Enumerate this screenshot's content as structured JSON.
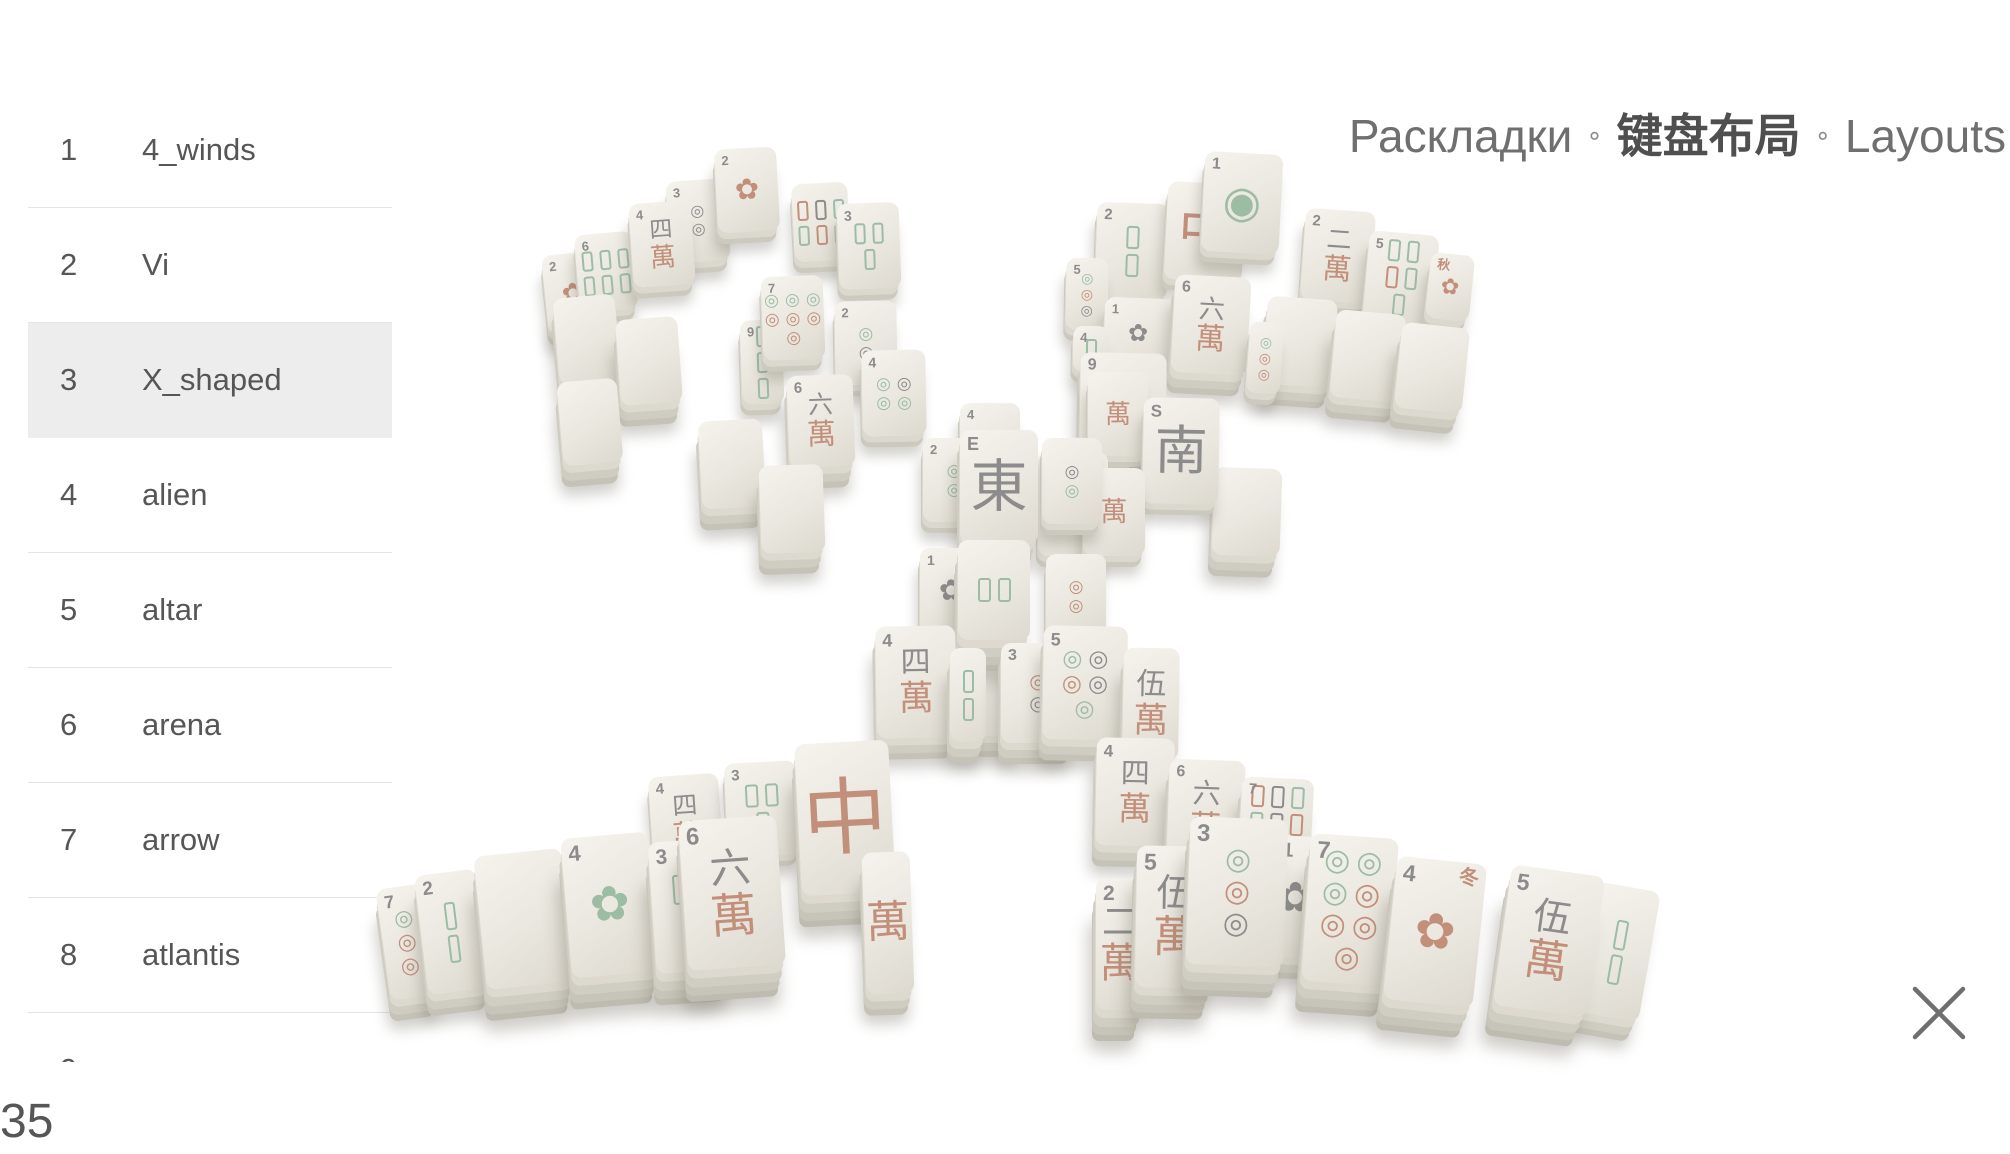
{
  "header": {
    "title_ru": "Раскладки",
    "title_zh": "键盘布局",
    "title_en": "Layouts",
    "separator": "∘"
  },
  "sidebar": {
    "items": [
      {
        "num": "1",
        "label": "4_winds",
        "selected": false
      },
      {
        "num": "2",
        "label": "Vi",
        "selected": false
      },
      {
        "num": "3",
        "label": "X_shaped",
        "selected": true
      },
      {
        "num": "4",
        "label": "alien",
        "selected": false
      },
      {
        "num": "5",
        "label": "altar",
        "selected": false
      },
      {
        "num": "6",
        "label": "arena",
        "selected": false
      },
      {
        "num": "7",
        "label": "arrow",
        "selected": false
      },
      {
        "num": "8",
        "label": "atlantis",
        "selected": false
      },
      {
        "num": "9",
        "label": "",
        "selected": false
      }
    ]
  },
  "footer": {
    "layout_count": "35"
  },
  "icons": {
    "close": "✕"
  },
  "board": {
    "colors": {
      "g": "#9cbda4",
      "r": "#c28f7a",
      "k": "#8c8c8c"
    },
    "glyphs": {
      "man": "萬",
      "dot": "◎",
      "one": "◉",
      "flower": "✿"
    },
    "tiles": [
      {
        "x": 545,
        "y": 253,
        "w": 56,
        "h": 80,
        "r": -6,
        "d": 1,
        "k": "flower",
        "n": "2",
        "fc": "r"
      },
      {
        "x": 577,
        "y": 233,
        "w": 58,
        "h": 78,
        "r": -5,
        "d": 1,
        "k": "bamboo",
        "n": "6",
        "cols": 3,
        "sticks": [
          "g",
          "g",
          "g",
          "g",
          "g",
          "g"
        ]
      },
      {
        "x": 668,
        "y": 180,
        "w": 60,
        "h": 82,
        "r": -4,
        "d": 1,
        "k": "circles",
        "n": "3",
        "cols": 1,
        "dots": [
          "k",
          "k"
        ]
      },
      {
        "x": 631,
        "y": 202,
        "w": 62,
        "h": 84,
        "r": -4,
        "d": 1,
        "k": "man",
        "n": "4",
        "t": "四"
      },
      {
        "x": 716,
        "y": 148,
        "w": 62,
        "h": 84,
        "r": -3,
        "d": 1,
        "k": "flower",
        "n": "2",
        "fc": "r"
      },
      {
        "x": 793,
        "y": 183,
        "w": 56,
        "h": 78,
        "r": -3,
        "d": 1,
        "k": "bamboo",
        "n": "",
        "cols": 3,
        "sticks": [
          "r",
          "k",
          "g",
          "g",
          "r",
          "g"
        ]
      },
      {
        "x": 838,
        "y": 203,
        "w": 62,
        "h": 86,
        "r": -2,
        "d": 1,
        "k": "bamboo",
        "n": "3",
        "cols": 2,
        "sticks": [
          "g",
          "g",
          "g"
        ]
      },
      {
        "x": 556,
        "y": 296,
        "w": 62,
        "h": 86,
        "r": -5,
        "d": 2,
        "k": "blank"
      },
      {
        "x": 618,
        "y": 318,
        "w": 62,
        "h": 86,
        "r": -4,
        "d": 2,
        "k": "blank"
      },
      {
        "x": 560,
        "y": 380,
        "w": 60,
        "h": 84,
        "r": -5,
        "d": 2,
        "k": "blank"
      },
      {
        "x": 741,
        "y": 320,
        "w": 42,
        "h": 84,
        "r": -2,
        "d": 1,
        "k": "bamboo",
        "n": "9",
        "cols": 1,
        "sticks": [
          "g",
          "g",
          "g"
        ]
      },
      {
        "x": 762,
        "y": 276,
        "w": 62,
        "h": 84,
        "r": -2,
        "d": 1,
        "k": "circles",
        "n": "7",
        "cols": 3,
        "dots": [
          "g",
          "g",
          "g",
          "r",
          "r",
          "r",
          "r"
        ]
      },
      {
        "x": 835,
        "y": 301,
        "w": 62,
        "h": 84,
        "r": -1,
        "d": 1,
        "k": "circles",
        "n": "2",
        "cols": 1,
        "dots": [
          "g",
          "k"
        ]
      },
      {
        "x": 862,
        "y": 350,
        "w": 64,
        "h": 86,
        "r": -1,
        "d": 1,
        "k": "circles",
        "n": "4",
        "cols": 2,
        "dots": [
          "g",
          "k",
          "g",
          "g"
        ]
      },
      {
        "x": 788,
        "y": 375,
        "w": 66,
        "h": 92,
        "r": -2,
        "d": 2,
        "k": "man",
        "n": "6",
        "t": "六"
      },
      {
        "x": 700,
        "y": 420,
        "w": 64,
        "h": 88,
        "r": -3,
        "d": 2,
        "k": "blank"
      },
      {
        "x": 760,
        "y": 465,
        "w": 64,
        "h": 88,
        "r": -2,
        "d": 2,
        "k": "blank"
      },
      {
        "x": 1096,
        "y": 203,
        "w": 72,
        "h": 96,
        "r": 2,
        "d": 1,
        "k": "bamboo",
        "n": "2",
        "cols": 1,
        "sticks": [
          "g",
          "g"
        ]
      },
      {
        "x": 1166,
        "y": 183,
        "w": 78,
        "h": 98,
        "r": 3,
        "d": 1,
        "k": "dragon",
        "n": "",
        "ch": "中"
      },
      {
        "x": 1203,
        "y": 153,
        "w": 78,
        "h": 100,
        "r": 3,
        "d": 1,
        "k": "one",
        "n": "1"
      },
      {
        "x": 1303,
        "y": 210,
        "w": 70,
        "h": 92,
        "r": 4,
        "d": 1,
        "k": "man",
        "n": "2",
        "t": "二"
      },
      {
        "x": 1366,
        "y": 233,
        "w": 70,
        "h": 90,
        "r": 5,
        "d": 1,
        "k": "bamboo",
        "n": "5",
        "cols": 2,
        "sticks": [
          "g",
          "g",
          "r",
          "g",
          "g"
        ]
      },
      {
        "x": 1428,
        "y": 254,
        "w": 44,
        "h": 66,
        "r": 6,
        "d": 1,
        "k": "flower",
        "n": "秋",
        "nc": "r",
        "fc": "r"
      },
      {
        "x": 1265,
        "y": 298,
        "w": 70,
        "h": 88,
        "r": 4,
        "d": 2,
        "k": "blank"
      },
      {
        "x": 1333,
        "y": 312,
        "w": 70,
        "h": 88,
        "r": 5,
        "d": 2,
        "k": "blank"
      },
      {
        "x": 1398,
        "y": 325,
        "w": 68,
        "h": 86,
        "r": 6,
        "d": 2,
        "k": "blank"
      },
      {
        "x": 1066,
        "y": 258,
        "w": 42,
        "h": 72,
        "r": 1,
        "d": 1,
        "k": "circles",
        "n": "5",
        "cols": 1,
        "dots": [
          "g",
          "r",
          "k"
        ]
      },
      {
        "x": 1104,
        "y": 298,
        "w": 68,
        "h": 72,
        "r": 2,
        "d": 1,
        "k": "flower",
        "n": "1",
        "fc": "k"
      },
      {
        "x": 1073,
        "y": 326,
        "w": 36,
        "h": 46,
        "r": 1,
        "d": 1,
        "k": "bamboo",
        "n": "4",
        "cols": 1,
        "sticks": [
          "g"
        ]
      },
      {
        "x": 1173,
        "y": 276,
        "w": 76,
        "h": 98,
        "r": 3,
        "d": 2,
        "k": "man",
        "n": "6",
        "t": "六"
      },
      {
        "x": 1248,
        "y": 322,
        "w": 34,
        "h": 72,
        "r": 4,
        "d": 1,
        "k": "circles",
        "n": "",
        "cols": 1,
        "dots": [
          "g",
          "r",
          "r"
        ]
      },
      {
        "x": 1080,
        "y": 353,
        "w": 86,
        "h": 100,
        "r": 1,
        "d": 2,
        "k": "man",
        "n": "9",
        "t": "九"
      },
      {
        "x": 1063,
        "y": 438,
        "w": 66,
        "h": 88,
        "r": 1,
        "d": 2,
        "k": "blank"
      },
      {
        "x": 1213,
        "y": 468,
        "w": 68,
        "h": 88,
        "r": 2,
        "d": 2,
        "k": "blank"
      },
      {
        "x": 1088,
        "y": 372,
        "w": 60,
        "h": 84,
        "r": 0,
        "d": 1,
        "k": "man",
        "n": "",
        "t": ""
      },
      {
        "x": 1143,
        "y": 398,
        "w": 76,
        "h": 106,
        "r": 1,
        "d": 1,
        "k": "wind",
        "n": "S",
        "ch": "南"
      },
      {
        "x": 960,
        "y": 403,
        "w": 60,
        "h": 80,
        "r": 0,
        "d": 1,
        "k": "bamboo",
        "n": "4",
        "cols": 2,
        "sticks": [
          "g",
          "g"
        ]
      },
      {
        "x": 923,
        "y": 438,
        "w": 62,
        "h": 84,
        "r": 0,
        "d": 1,
        "k": "circles",
        "n": "2",
        "cols": 1,
        "dots": [
          "g",
          "g"
        ]
      },
      {
        "x": 1038,
        "y": 452,
        "w": 70,
        "h": 104,
        "r": 0,
        "d": 1,
        "k": "wind",
        "n": "E",
        "ch": "東"
      },
      {
        "x": 1083,
        "y": 468,
        "w": 62,
        "h": 88,
        "r": 0,
        "d": 1,
        "k": "man",
        "n": "",
        "t": ""
      },
      {
        "x": 1042,
        "y": 438,
        "w": 60,
        "h": 86,
        "r": 0,
        "d": 1,
        "k": "circles",
        "n": "",
        "cols": 1,
        "dots": [
          "k",
          "g"
        ]
      },
      {
        "x": 960,
        "y": 430,
        "w": 78,
        "h": 114,
        "r": 0,
        "d": 2,
        "k": "wind",
        "n": "E",
        "ch": "東"
      },
      {
        "x": 920,
        "y": 548,
        "w": 62,
        "h": 86,
        "r": 0,
        "d": 1,
        "k": "flower",
        "n": "1",
        "fc": "k"
      },
      {
        "x": 1046,
        "y": 554,
        "w": 60,
        "h": 84,
        "r": 0,
        "d": 1,
        "k": "circles",
        "n": "",
        "cols": 1,
        "dots": [
          "r",
          "r"
        ]
      },
      {
        "x": 956,
        "y": 642,
        "w": 68,
        "h": 94,
        "r": 0,
        "d": 2,
        "k": "blank"
      },
      {
        "x": 958,
        "y": 540,
        "w": 72,
        "h": 100,
        "r": 0,
        "d": 3,
        "k": "bamboo",
        "n": "",
        "cols": 2,
        "sticks": [
          "g",
          "g"
        ]
      },
      {
        "x": 876,
        "y": 626,
        "w": 80,
        "h": 112,
        "r": -1,
        "d": 2,
        "k": "man",
        "n": "4",
        "t": "四"
      },
      {
        "x": 950,
        "y": 648,
        "w": 36,
        "h": 94,
        "r": 0,
        "d": 2,
        "k": "bamboo",
        "n": "",
        "cols": 1,
        "sticks": [
          "g",
          "g"
        ]
      },
      {
        "x": 1001,
        "y": 643,
        "w": 74,
        "h": 100,
        "r": 0,
        "d": 2,
        "k": "circles",
        "n": "3",
        "cols": 1,
        "dots": [
          "r",
          "k"
        ]
      },
      {
        "x": 1043,
        "y": 626,
        "w": 84,
        "h": 114,
        "r": 1,
        "d": 2,
        "k": "circles",
        "n": "5",
        "cols": 2,
        "dots": [
          "g",
          "k",
          "r",
          "k",
          "g"
        ]
      },
      {
        "x": 1123,
        "y": 648,
        "w": 56,
        "h": 112,
        "r": 1,
        "d": 2,
        "k": "man",
        "n": "",
        "t": "伍"
      },
      {
        "x": 383,
        "y": 886,
        "w": 48,
        "h": 112,
        "r": -8,
        "d": 2,
        "k": "circles",
        "n": "7",
        "cols": 1,
        "dots": [
          "g",
          "r",
          "r"
        ]
      },
      {
        "x": 421,
        "y": 872,
        "w": 62,
        "h": 120,
        "r": -7,
        "d": 2,
        "k": "bamboo",
        "n": "2",
        "cols": 1,
        "sticks": [
          "g",
          "g"
        ]
      },
      {
        "x": 651,
        "y": 775,
        "w": 70,
        "h": 94,
        "r": -4,
        "d": 1,
        "k": "man",
        "n": "4",
        "t": "四"
      },
      {
        "x": 726,
        "y": 762,
        "w": 72,
        "h": 94,
        "r": -3,
        "d": 1,
        "k": "bamboo",
        "n": "3",
        "cols": 2,
        "sticks": [
          "g",
          "g",
          "g"
        ]
      },
      {
        "x": 480,
        "y": 852,
        "w": 88,
        "h": 134,
        "r": -6,
        "d": 3,
        "k": "blank"
      },
      {
        "x": 566,
        "y": 835,
        "w": 88,
        "h": 140,
        "r": -5,
        "d": 3,
        "k": "flower",
        "n": "4",
        "fc": "g"
      },
      {
        "x": 652,
        "y": 840,
        "w": 76,
        "h": 132,
        "r": -4,
        "d": 3,
        "k": "bamboo",
        "n": "3",
        "cols": 2,
        "sticks": [
          "g",
          "g",
          "g"
        ]
      },
      {
        "x": 683,
        "y": 818,
        "w": 98,
        "h": 150,
        "r": -4,
        "d": 3,
        "k": "man",
        "n": "6",
        "t": "六"
      },
      {
        "x": 798,
        "y": 742,
        "w": 94,
        "h": 152,
        "r": -3,
        "d": 3,
        "k": "dragon",
        "n": "",
        "ch": "中"
      },
      {
        "x": 864,
        "y": 852,
        "w": 48,
        "h": 142,
        "r": -2,
        "d": 2,
        "k": "man",
        "n": "",
        "t": ""
      },
      {
        "x": 1096,
        "y": 738,
        "w": 78,
        "h": 108,
        "r": 1,
        "d": 2,
        "k": "man",
        "n": "4",
        "t": "四"
      },
      {
        "x": 1168,
        "y": 760,
        "w": 76,
        "h": 102,
        "r": 2,
        "d": 2,
        "k": "man",
        "n": "6",
        "t": "六"
      },
      {
        "x": 1240,
        "y": 778,
        "w": 72,
        "h": 92,
        "r": 3,
        "d": 2,
        "k": "bamboo",
        "n": "7",
        "cols": 3,
        "sticks": [
          "r",
          "k",
          "g",
          "g",
          "k",
          "r",
          "g"
        ]
      },
      {
        "x": 1096,
        "y": 878,
        "w": 48,
        "h": 132,
        "r": 0,
        "d": 3,
        "k": "man",
        "n": "2",
        "t": "二"
      },
      {
        "x": 1136,
        "y": 846,
        "w": 78,
        "h": 142,
        "r": 1,
        "d": 3,
        "k": "man",
        "n": "5",
        "t": "伍"
      },
      {
        "x": 1273,
        "y": 836,
        "w": 44,
        "h": 122,
        "r": 3,
        "d": 2,
        "k": "flower",
        "n": "1",
        "fc": "k"
      },
      {
        "x": 1188,
        "y": 818,
        "w": 98,
        "h": 148,
        "r": 2,
        "d": 3,
        "k": "circles",
        "n": "3",
        "cols": 1,
        "dots": [
          "g",
          "r",
          "k"
        ]
      },
      {
        "x": 1306,
        "y": 836,
        "w": 88,
        "h": 148,
        "r": 4,
        "d": 3,
        "k": "circles",
        "n": "7",
        "cols": 3,
        "dots": [
          "g",
          "g",
          "g",
          "r",
          "r",
          "r",
          "r"
        ]
      },
      {
        "x": 1586,
        "y": 886,
        "w": 64,
        "h": 132,
        "r": 10,
        "d": 2,
        "k": "bamboo",
        "n": "",
        "cols": 1,
        "sticks": [
          "g",
          "g"
        ]
      },
      {
        "x": 1390,
        "y": 860,
        "w": 90,
        "h": 144,
        "r": 6,
        "d": 3,
        "k": "flower",
        "n": "4",
        "fc": "r",
        "season": "冬"
      },
      {
        "x": 1502,
        "y": 870,
        "w": 94,
        "h": 142,
        "r": 8,
        "d": 3,
        "k": "man",
        "n": "5",
        "t": "伍"
      }
    ]
  }
}
